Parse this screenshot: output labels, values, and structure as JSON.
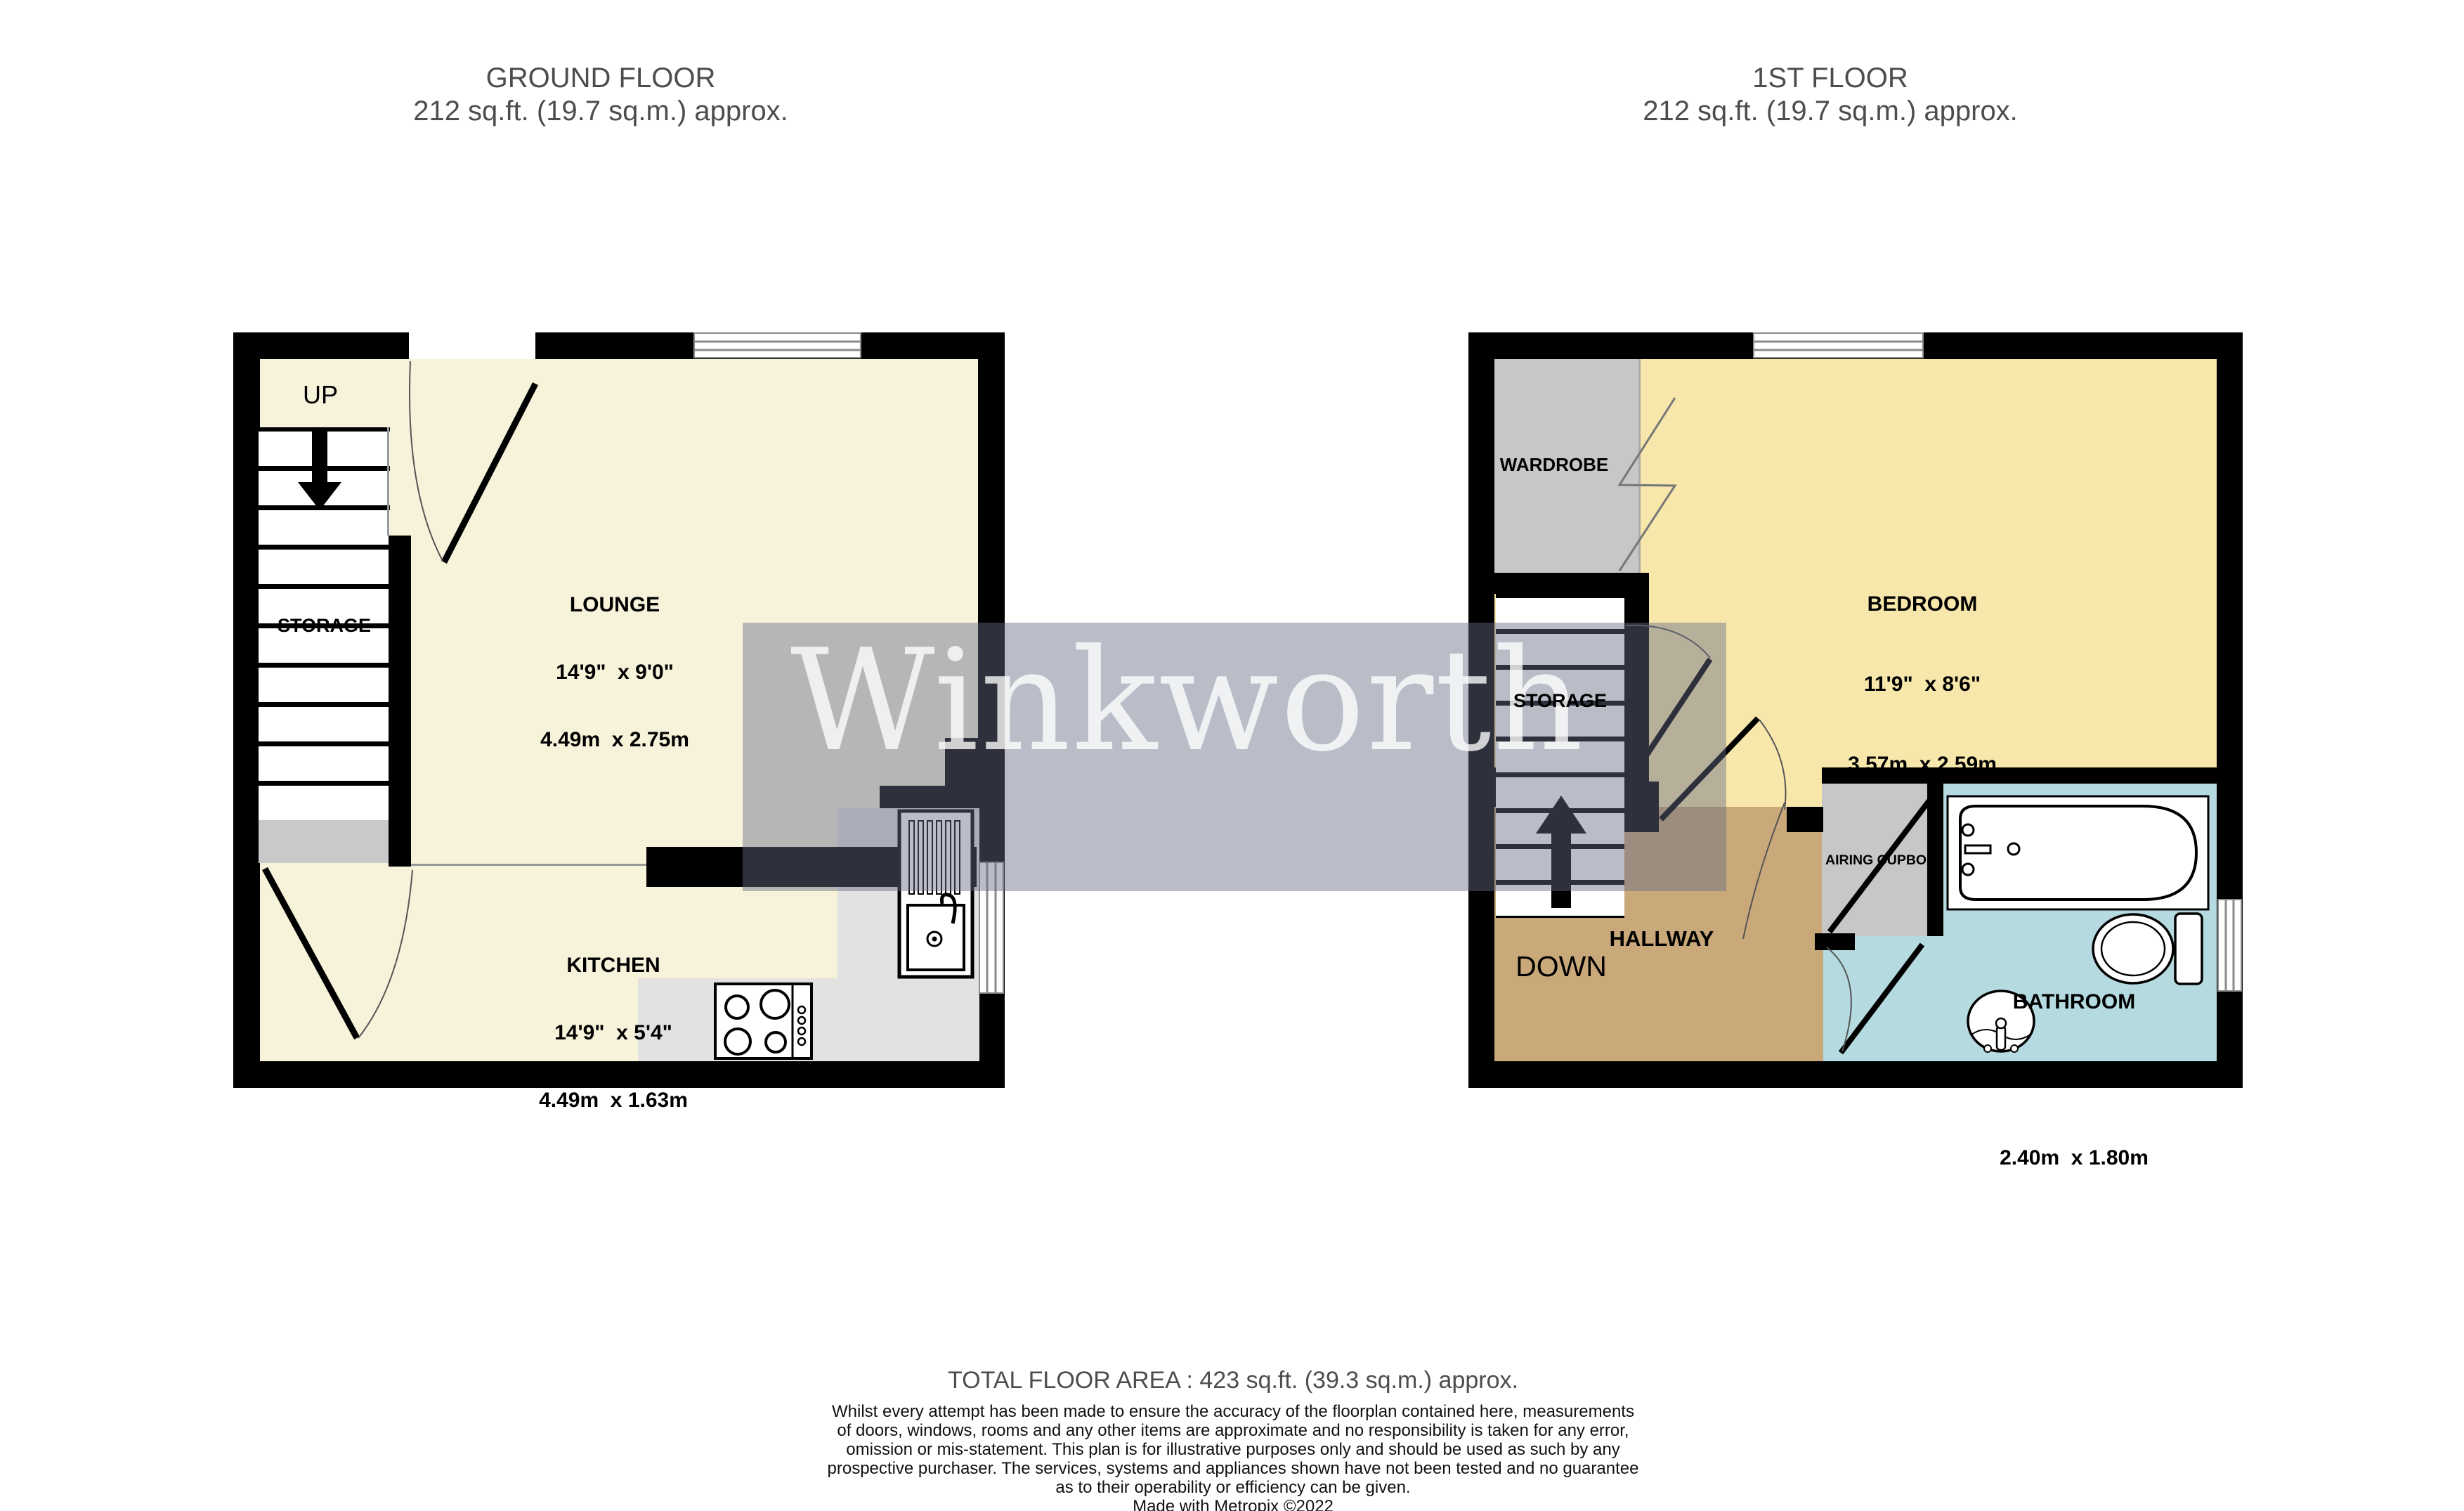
{
  "titles": {
    "ground": {
      "line1": "GROUND FLOOR",
      "line2": "212 sq.ft. (19.7 sq.m.) approx."
    },
    "first": {
      "line1": "1ST FLOOR",
      "line2": "212 sq.ft. (19.7 sq.m.) approx."
    }
  },
  "ground_floor": {
    "up_label": "UP",
    "storage_label": "STORAGE",
    "lounge": {
      "name": "LOUNGE",
      "imperial": "14'9\"  x 9'0\"",
      "metric": "4.49m  x 2.75m"
    },
    "kitchen": {
      "name": "KITCHEN",
      "imperial": "14'9\"  x 5'4\"",
      "metric": "4.49m  x 1.63m"
    }
  },
  "first_floor": {
    "wardrobe_label": "WARDROBE",
    "storage_label": "STORAGE",
    "down_label": "DOWN",
    "hallway_label": "HALLWAY",
    "airing_cupboard_label": "AIRING CUPBOARD",
    "bedroom": {
      "name": "BEDROOM",
      "imperial": "11'9\"  x 8'6\"",
      "metric": "3.57m  x 2.59m"
    },
    "bathroom": {
      "name": "BATHROOM",
      "imperial": "7'11\"  x 5'11\"",
      "metric": "2.40m  x 1.80m"
    }
  },
  "watermark": "Winkworth",
  "footer": {
    "total": "TOTAL FLOOR AREA : 423 sq.ft. (39.3 sq.m.) approx.",
    "disclaimer_lines": [
      "Whilst every attempt has been made to ensure the accuracy of the floorplan contained here, measurements",
      "of doors, windows, rooms and any other items are approximate and no responsibility is taken for any error,",
      "omission or mis-statement. This plan is for illustrative purposes only and should be used as such by any",
      "prospective purchaser. The services, systems and appliances shown have not been tested and no guarantee",
      "as to their operability or efficiency can be given.",
      "Made with Metropix ©2022"
    ]
  },
  "colors": {
    "wall": "#000000",
    "lounge_kitchen_floor": "#f7f2da",
    "bedroom_floor": "#f8e7ab",
    "hallway_floor": "#c9a87a",
    "bathroom_floor": "#b5dbe1",
    "cupboard_gray": "#c7c7c7",
    "counter_gray": "#e2e2e0",
    "landing_gray": "#c9c9c9",
    "title_text": "#4d4d4d",
    "watermark_band": "rgba(103,109,132,0.45)",
    "watermark_text": "rgba(255,255,255,0.78)"
  }
}
